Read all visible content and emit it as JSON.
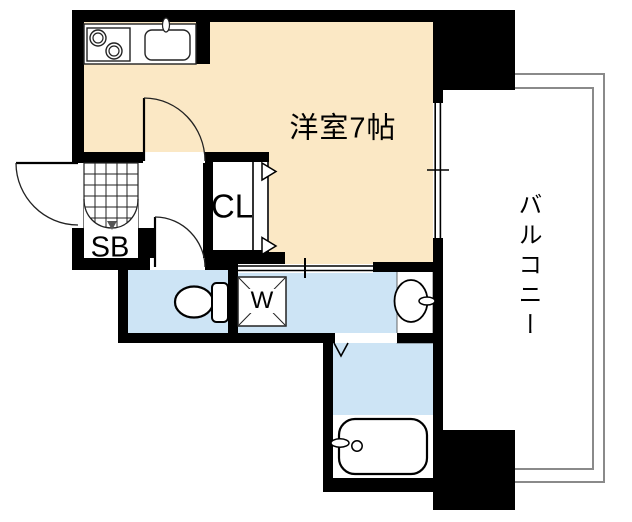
{
  "floorplan": {
    "labels": {
      "main_room": "洋室7帖",
      "closet": "CL",
      "shoe_box": "SB",
      "washer": "W",
      "balcony": "バルコニー"
    },
    "colors": {
      "wall": "#000000",
      "room_floor": "#FBE8C5",
      "wet_floor": "#CDE4F5",
      "fixture_white": "#FFFFFF",
      "balcony_line": "#8A8A8A",
      "background": "#FFFFFF"
    }
  }
}
